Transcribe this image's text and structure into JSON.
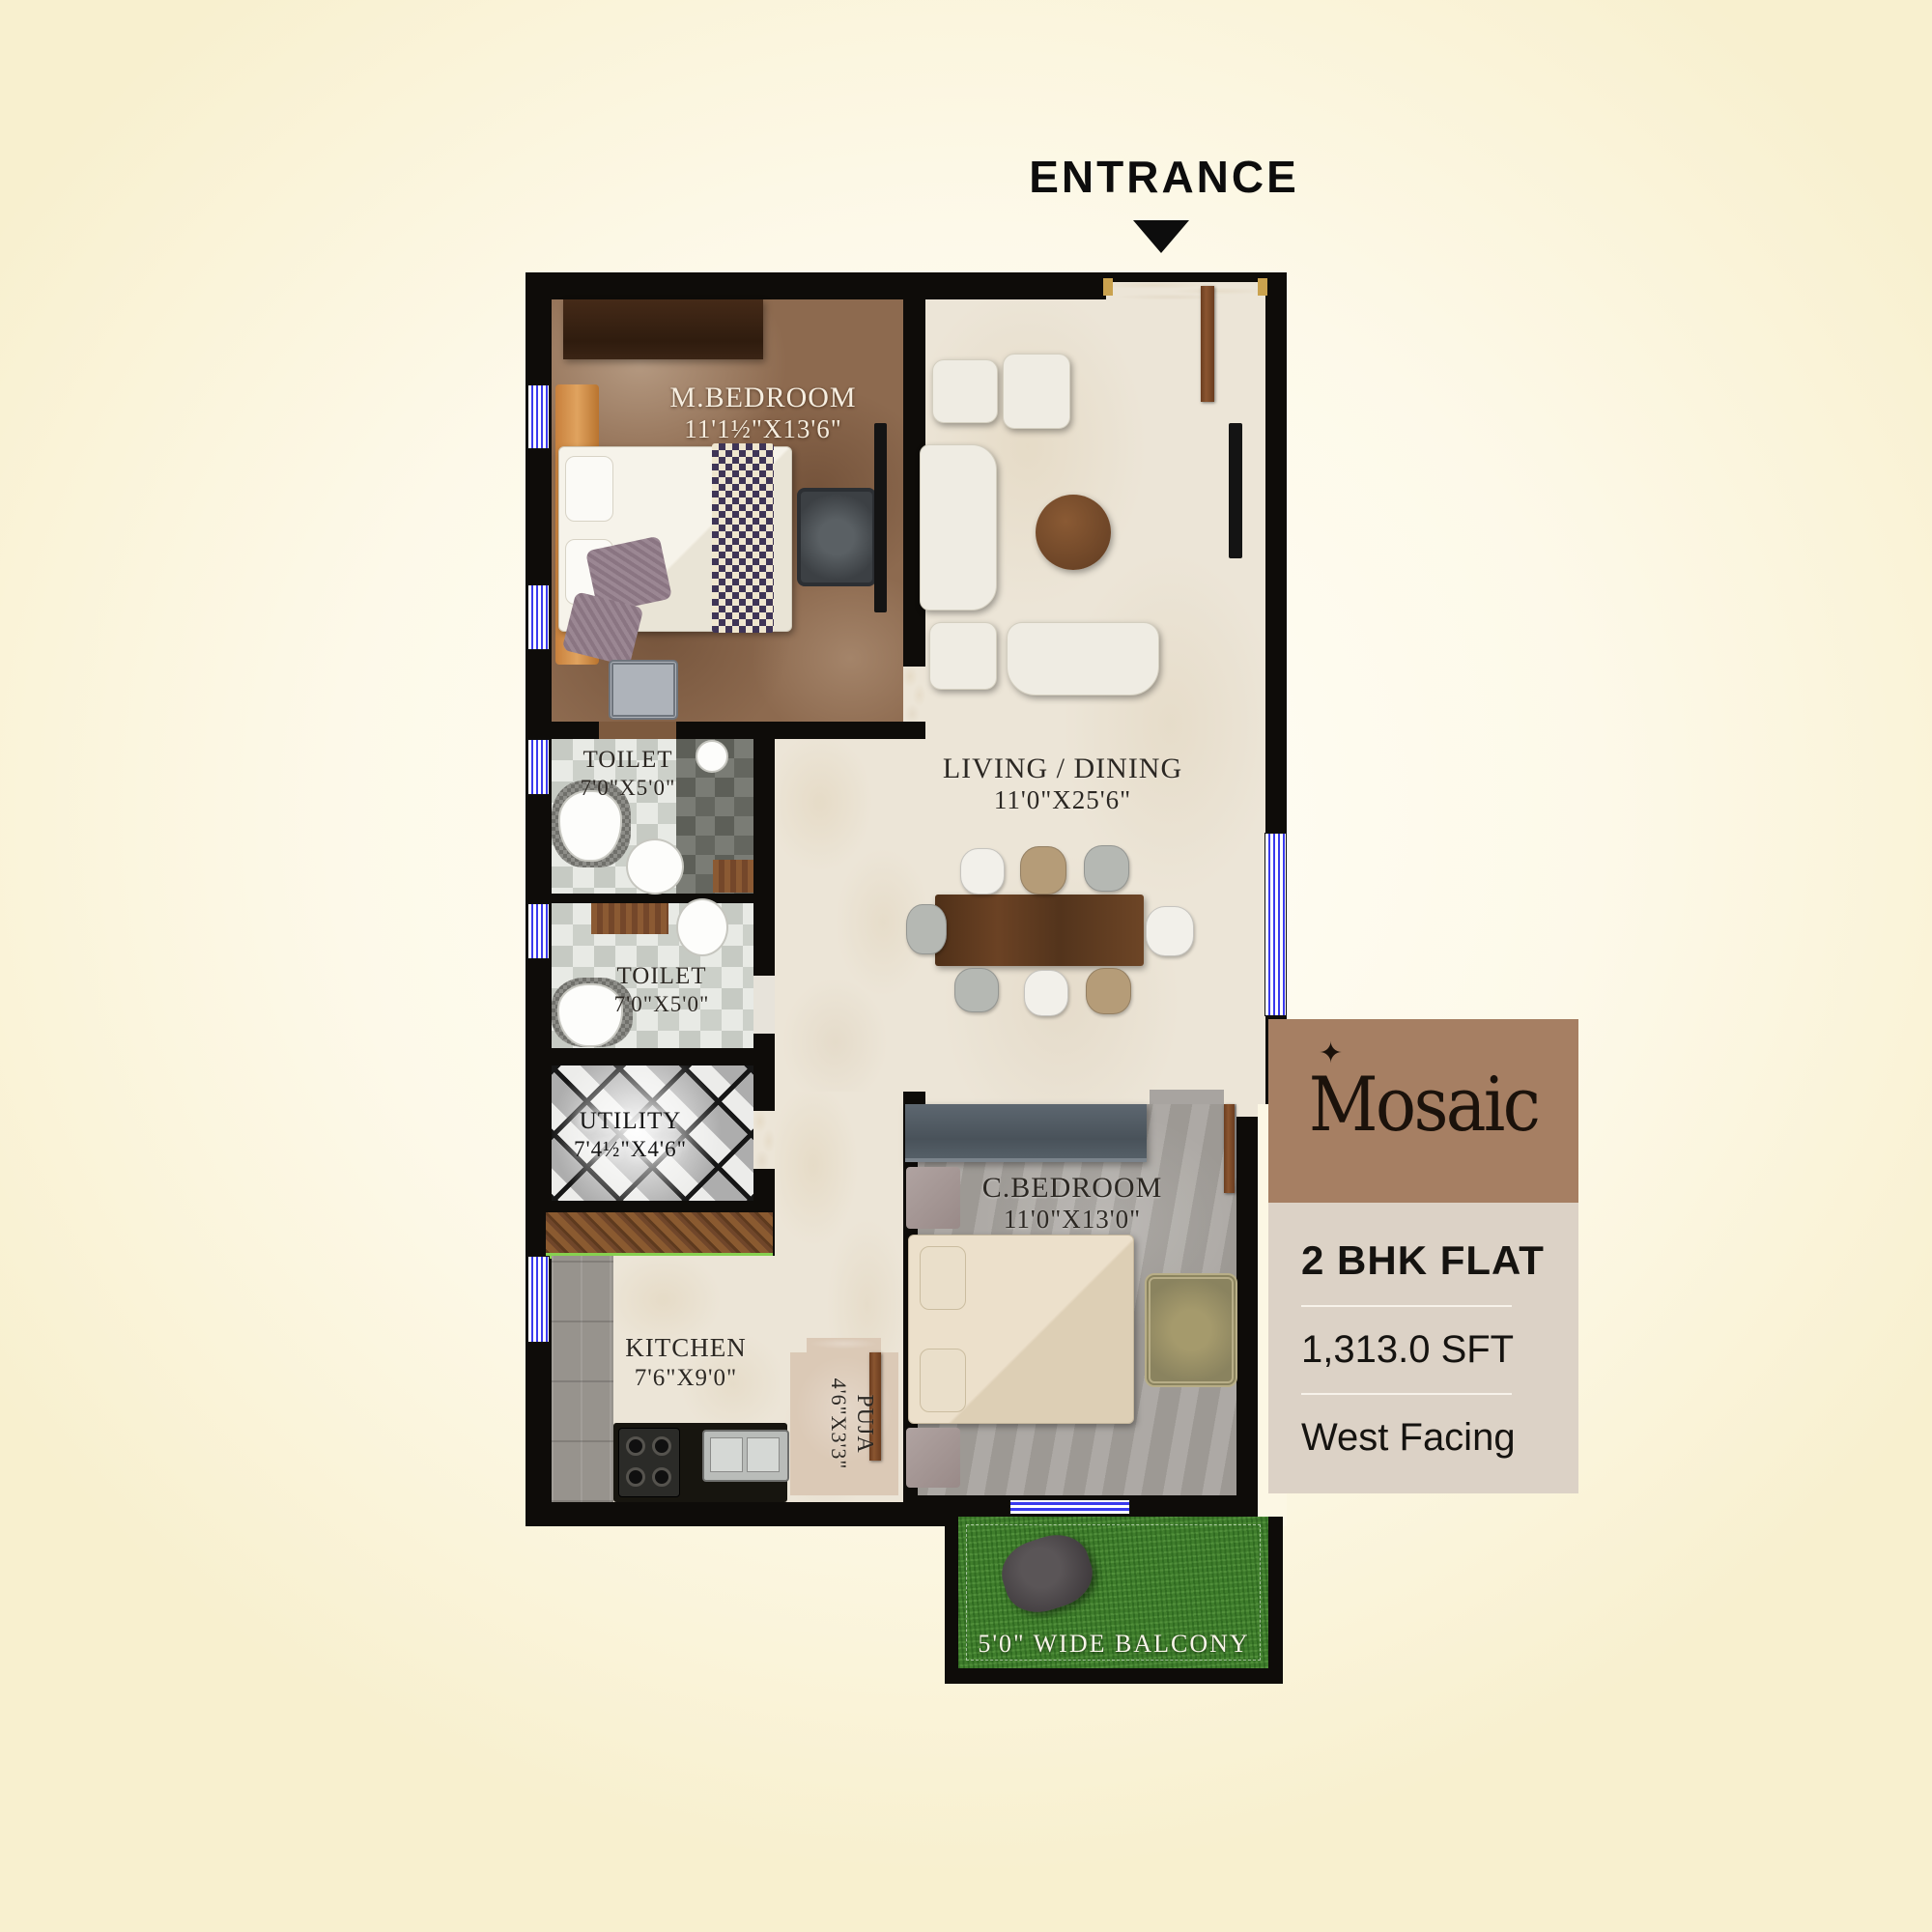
{
  "page": {
    "entrance_label": "ENTRANCE"
  },
  "rooms": {
    "m_bedroom": {
      "name": "M.BEDROOM",
      "dims": "11'1½\"X13'6\""
    },
    "living_dining": {
      "name": "LIVING / DINING",
      "dims": "11'0\"X25'6\""
    },
    "toilet_1": {
      "name": "TOILET",
      "dims": "7'0\"X5'0\""
    },
    "toilet_2": {
      "name": "TOILET",
      "dims": "7'0\"X5'0\""
    },
    "utility": {
      "name": "UTILITY",
      "dims": "7'4½\"X4'6\""
    },
    "kitchen": {
      "name": "KITCHEN",
      "dims": "7'6\"X9'0\""
    },
    "puja": {
      "name": "PUJA",
      "dims": "4'6\"X3'3\""
    },
    "c_bedroom": {
      "name": "C.BEDROOM",
      "dims": "11'0\"X13'0\""
    },
    "balcony": {
      "label": "5'0\" WIDE BALCONY"
    }
  },
  "info_panel": {
    "brand": "Mosaic",
    "sparkle": "✦",
    "flat_type": "2 BHK FLAT",
    "area": "1,313.0 SFT",
    "facing": "West Facing",
    "colors": {
      "header_bg": "#a67f63",
      "body_bg": "#dcd2c6",
      "wall": "#0e0c09",
      "grass": "#3f7d2c"
    }
  }
}
